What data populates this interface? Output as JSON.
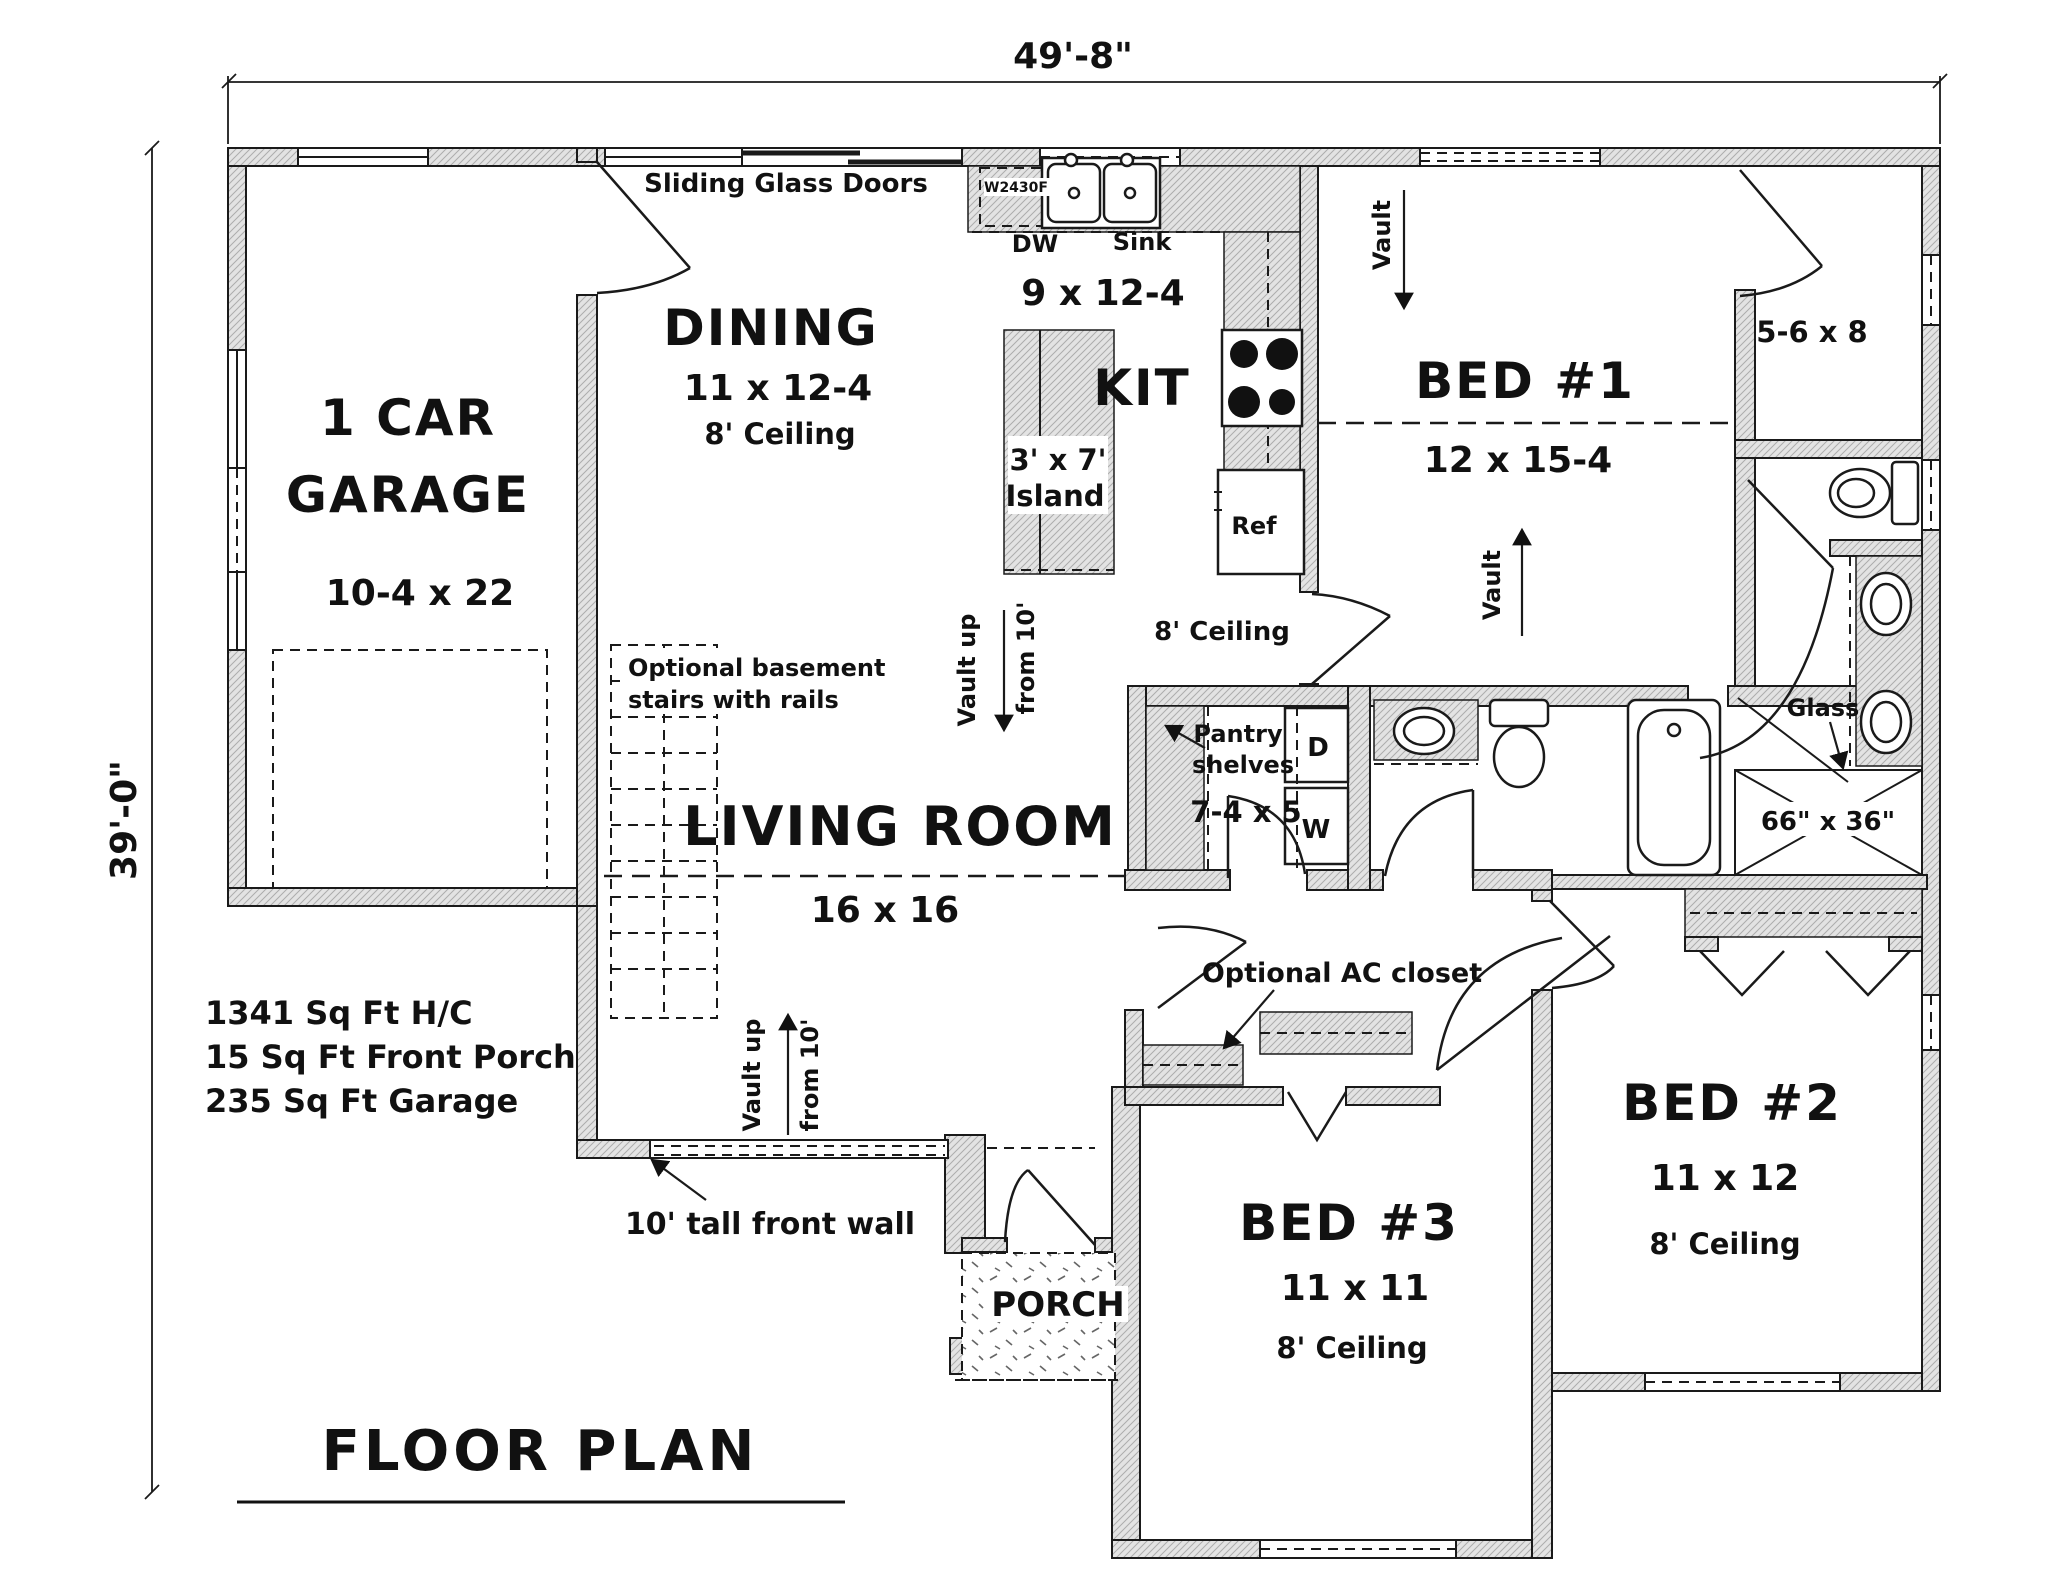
{
  "drawing": {
    "title": "FLOOR PLAN",
    "dim_top": "49'-8\"",
    "dim_left": "39'-0\"",
    "stats": {
      "line1": "1341 Sq Ft H/C",
      "line2": "15 Sq Ft Front Porch",
      "line3": "235 Sq Ft Garage"
    },
    "front_wall_note": "10' tall front wall"
  },
  "rooms": {
    "garage": {
      "name1": "1 CAR",
      "name2": "GARAGE",
      "size": "10-4 x 22"
    },
    "dining": {
      "name": "DINING",
      "size": "11 x 12-4",
      "ceiling": "8' Ceiling"
    },
    "kitchen": {
      "name": "KIT",
      "size": "9 x 12-4",
      "ceiling": "8' Ceiling"
    },
    "living": {
      "name": "LIVING ROOM",
      "size": "16 x 16"
    },
    "bed1": {
      "name": "BED #1",
      "size": "12 x 15-4"
    },
    "bed2": {
      "name": "BED #2",
      "size": "11 x 12",
      "ceiling": "8' Ceiling"
    },
    "bed3": {
      "name": "BED #3",
      "size": "11 x 11",
      "ceiling": "8' Ceiling"
    },
    "porch": {
      "name": "PORCH"
    },
    "closet1": {
      "size": "5-6 x 8"
    },
    "laundry": {
      "size": "7-4 x 5"
    },
    "shower": {
      "size": "66\" x 36\""
    }
  },
  "fixtures": {
    "dw": "DW",
    "sink": "Sink",
    "ref": "Ref",
    "cabinet": "W2430F",
    "island_size": "3' x 7'",
    "island_word": "Island",
    "dryer": "D",
    "washer": "W",
    "glass": "Glass"
  },
  "annotations": {
    "sliding": "Sliding Glass Doors",
    "vault": "Vault",
    "vault_up": "Vault up",
    "from_10": "from 10'",
    "stairs1": "Optional basement",
    "stairs2": "stairs with rails",
    "pantry1": "Pantry",
    "pantry2": "shelves",
    "ac_closet": "Optional AC closet"
  }
}
